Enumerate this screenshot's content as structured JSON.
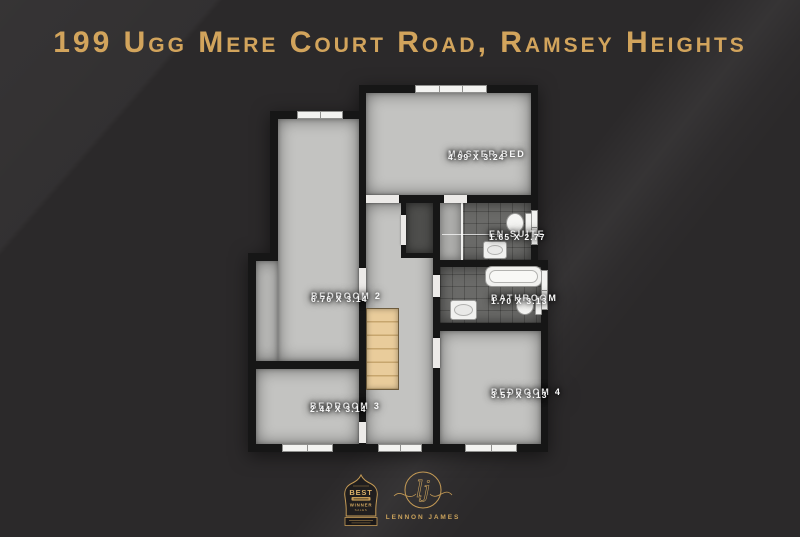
{
  "title": "199 Ugg Mere Court Road, Ramsey Heights",
  "plan": {
    "rooms": {
      "master": {
        "name": "MASTER BED",
        "dims": "4.99 X 3.24"
      },
      "ensuite": {
        "name": "EN-SUITE",
        "dims": "1.65 X 2.77"
      },
      "bathroom": {
        "name": "BATHROOM",
        "dims": "1.70 X 3.13"
      },
      "bedroom2": {
        "name": "BEDROOM 2",
        "dims": "6.76 X 3.14"
      },
      "bedroom3": {
        "name": "BEDROOM 3",
        "dims": "2.44 X 3.14"
      },
      "bedroom4": {
        "name": "BEDROOM 4",
        "dims": "3.57 X 3.13"
      }
    }
  },
  "branding": {
    "award_badge": {
      "title": "BEST",
      "award": "WINNER",
      "category": "SALES"
    },
    "agency": {
      "monogram": "lj",
      "name": "LENNON JAMES"
    }
  },
  "colors": {
    "background": "#2b292a",
    "title_gold": "#d2a45c",
    "logo_gold": "#c49a55",
    "floor_light": "#c3c3c1",
    "floor_tile": "#6a6a68",
    "wall": "#161616"
  }
}
